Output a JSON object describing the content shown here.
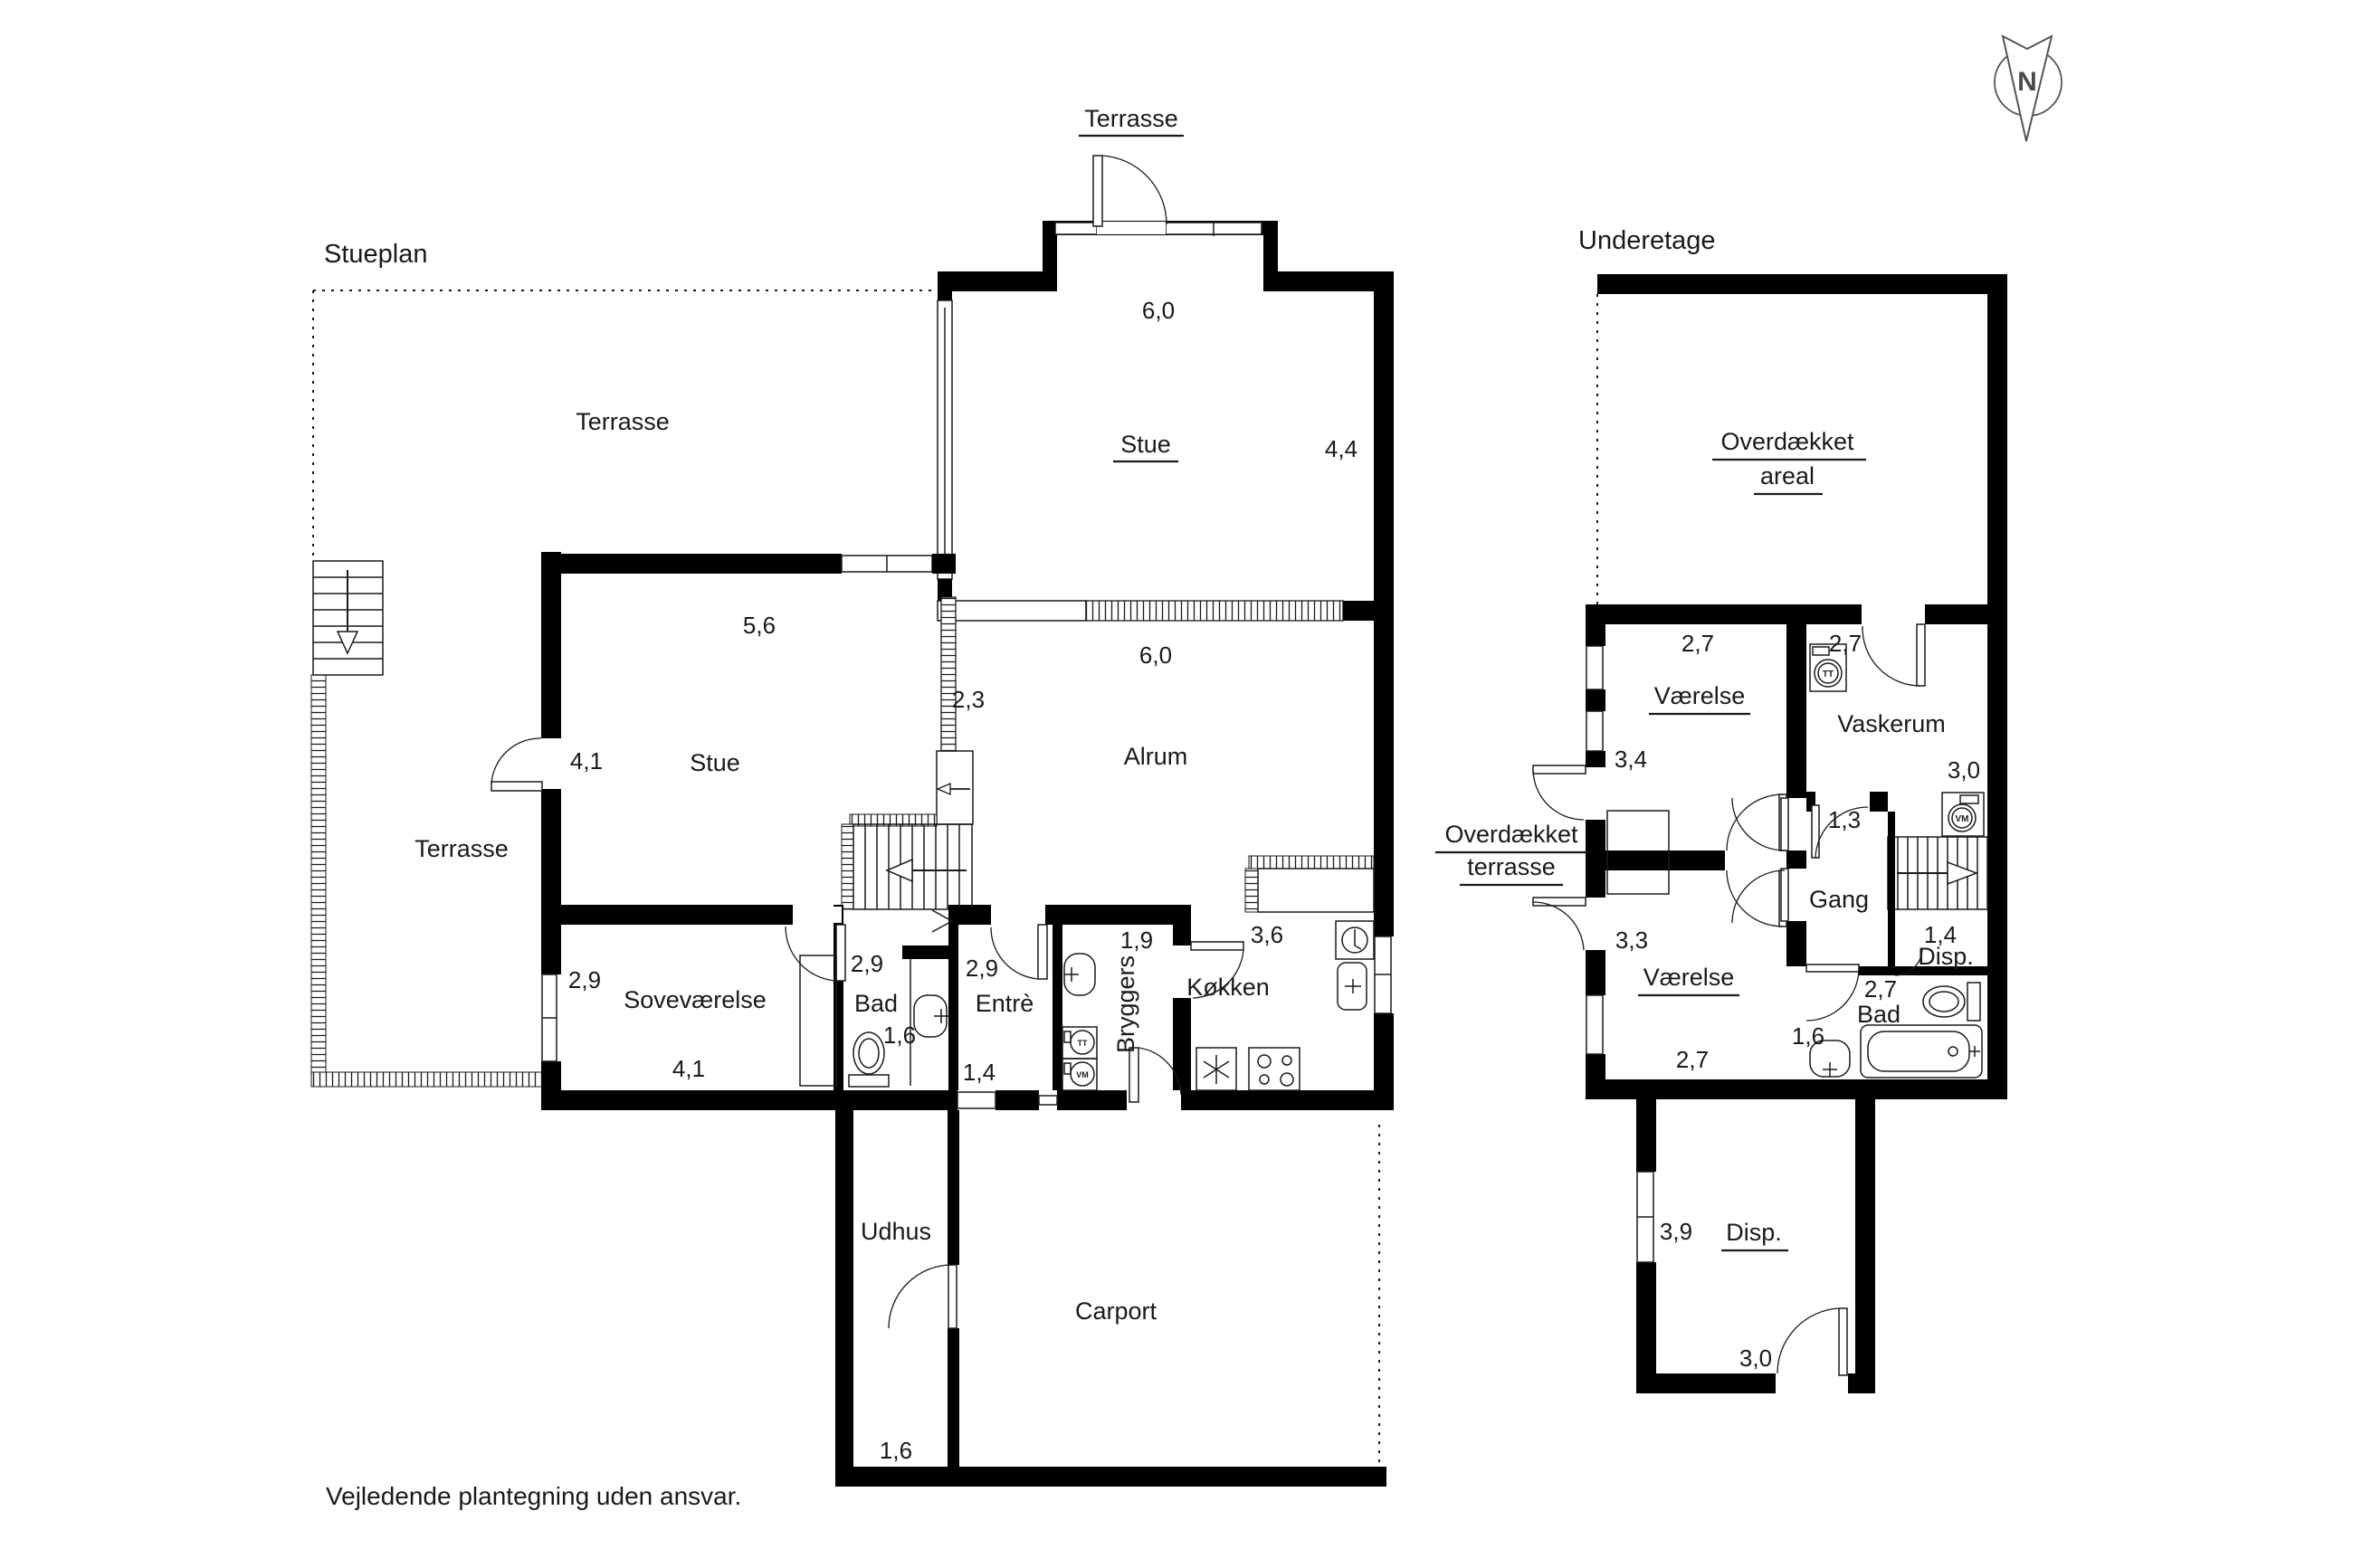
{
  "page": {
    "footer": "Vejledende plantegning uden ansvar."
  },
  "compass": {
    "letter": "N"
  },
  "plans": {
    "stueplan": {
      "title": "Stueplan",
      "labels": {
        "terrasse_top": "Terrasse",
        "terrasse_big": "Terrasse",
        "terrasse_left": "Terrasse",
        "stue_upper": "Stue",
        "stue_upper_w": "6,0",
        "stue_upper_h": "4,4",
        "alrum": "Alrum",
        "alrum_w": "6,0",
        "alrum_h": "2,3",
        "stue": "Stue",
        "stue_w": "5,6",
        "stue_h": "4,1",
        "sovevaerelse": "Soveværelse",
        "sov_h": "2,9",
        "sov_w": "4,1",
        "bad": "Bad",
        "bad_h": "2,9",
        "bad_w": "1,6",
        "entre": "Entrè",
        "entre_h": "2,9",
        "entre_w": "1,4",
        "bryggers": "Bryggers",
        "bryggers_w": "1,9",
        "kokken": "Køkken",
        "kokken_dim": "3,6",
        "udhus": "Udhus",
        "udhus_w": "1,6",
        "carport": "Carport"
      },
      "appliances": {
        "tt": "TT",
        "vm": "VM"
      }
    },
    "underetage": {
      "title": "Underetage",
      "labels": {
        "overdaekket_areal_1": "Overdækket",
        "overdaekket_areal_2": "areal",
        "vaerelse1": "Værelse",
        "v1_w": "2,7",
        "v1_h": "3,4",
        "vaskerum": "Vaskerum",
        "vask_w": "2,7",
        "vask_h": "3,0",
        "gang": "Gang",
        "gang_w": "1,3",
        "disp_small": "Disp.",
        "disp_small_w": "1,4",
        "bad": "Bad",
        "bad_w": "2,7",
        "bad_h": "1,6",
        "vaerelse2": "Værelse",
        "v2_h": "3,3",
        "v2_w": "2,7",
        "ov_terrasse_1": "Overdækket",
        "ov_terrasse_2": "terrasse",
        "disp": "Disp.",
        "disp_h": "3,9",
        "disp_w": "3,0"
      },
      "appliances": {
        "tt": "TT",
        "vm": "VM"
      }
    }
  }
}
